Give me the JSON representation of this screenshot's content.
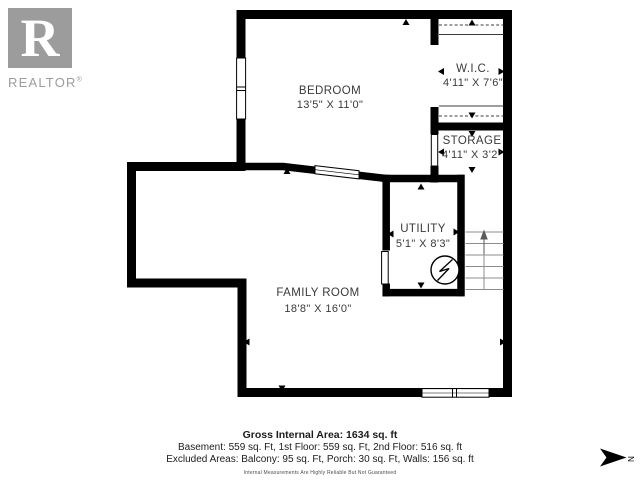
{
  "branding": {
    "logo_letter": "R",
    "logo_word": "REALTOR",
    "reg_mark": "®"
  },
  "rooms": {
    "bedroom": {
      "name": "BEDROOM",
      "dims": "13'5\" X 11'0\""
    },
    "wic": {
      "name": "W.I.C.",
      "dims": "4'11\" X 7'6\""
    },
    "storage": {
      "name": "STORAGE",
      "dims": "4'11\" X 3'2\""
    },
    "utility": {
      "name": "UTILITY",
      "dims": "5'1\" X 8'3\""
    },
    "family_room": {
      "name": "FAMILY ROOM",
      "dims": "18'8\" X 16'0\""
    }
  },
  "summary": {
    "title": "Gross Internal Area: 1634 sq. ft",
    "line1": "Basement: 559 sq. Ft, 1st Floor: 559 sq. Ft, 2nd Floor: 516 sq. ft",
    "line2": "Excluded Areas: Balcony: 95 sq. Ft, Porch: 30 sq. Ft, Walls: 156 sq. ft",
    "disclaimer": "Internal Measurements Are Highly Reliable But Not Guaranteed"
  },
  "compass": {
    "label": "N"
  },
  "colors": {
    "wall": "#000000",
    "room_label": "#3a3a3a",
    "logo_gray": "#9c9c9c"
  }
}
